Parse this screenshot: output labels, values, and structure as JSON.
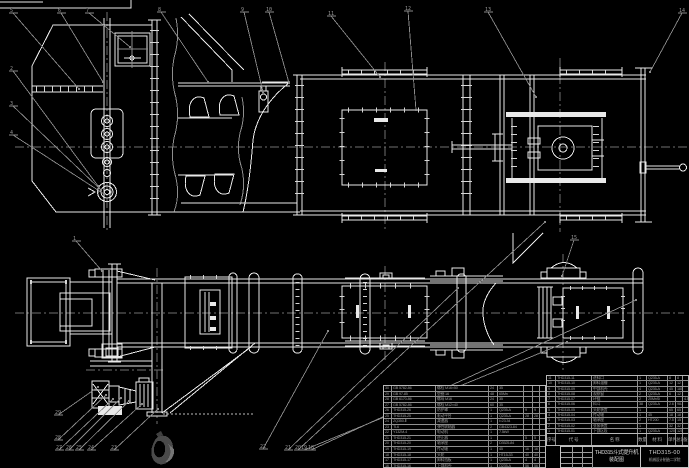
{
  "meta": {
    "background_color": "#000000",
    "line_color": "#e9e9e9",
    "annotation_color": "#8d8d8d",
    "table_text_color": "#9b9b9b",
    "drawing_type": "bucket-elevator assembly CAD drawing"
  },
  "title_block": {
    "product": "THD315斗式提升机",
    "doc_type": "装配图",
    "drawing_no": "THD315-00",
    "org": "机械设计制造二学院",
    "sig_rows": [
      [
        "",
        "",
        ""
      ],
      [
        "",
        "",
        ""
      ],
      [
        "",
        "",
        ""
      ],
      [
        "",
        "",
        ""
      ]
    ]
  },
  "bom_right": {
    "header": [
      "序号",
      "代  号",
      "名  称",
      "数量",
      "材  料",
      "单件",
      "总计",
      "备注"
    ],
    "rows": [
      [
        "11",
        "THD315-11",
        "进料口",
        "1",
        "Q235-A",
        "8",
        "8",
        ""
      ],
      [
        "10",
        "THD315-10",
        "卸料溜槽",
        "1",
        "Q235-A",
        "12",
        "12",
        ""
      ],
      [
        "9",
        "THD315-09",
        "中部机壳",
        "4",
        "Q235-A",
        "45",
        "180",
        ""
      ],
      [
        "8",
        "THD315-08",
        "观察窗",
        "2",
        "Q235-A",
        "6",
        "12",
        ""
      ],
      [
        "7",
        "THD315-07",
        "环链",
        "2",
        "20MnSi",
        "",
        "",
        "4.5m"
      ],
      [
        "6",
        "THD315-06",
        "料斗",
        "38",
        "Q235-A",
        "2.6",
        "98.8",
        ""
      ],
      [
        "5",
        "THD315-05",
        "头轮装置",
        "1",
        "",
        "65",
        "65",
        ""
      ],
      [
        "4",
        "THD315-04",
        "传动轴",
        "1",
        "45",
        "18",
        "18",
        ""
      ],
      [
        "3",
        "THD315-03",
        "轴承座",
        "2",
        "HT200",
        "7.5",
        "15",
        ""
      ],
      [
        "2",
        "THD315-02",
        "张紧装置",
        "1",
        "",
        "32",
        "32",
        ""
      ],
      [
        "1",
        "THD315-01",
        "下部区段",
        "1",
        "Q235-A",
        "120",
        "120",
        ""
      ]
    ]
  },
  "bom_left": {
    "rows": [
      [
        "30",
        "GB 5782-86",
        "螺栓 M16×50",
        "24",
        "35",
        "",
        "",
        ""
      ],
      [
        "29",
        "GB 97-85",
        "垫圈 16",
        "48",
        "65Mn",
        "",
        "",
        ""
      ],
      [
        "28",
        "GB 6170-86",
        "螺母 M16",
        "24",
        "35",
        "",
        "",
        ""
      ],
      [
        "27",
        "GB 5782-86",
        "螺栓 M12×40",
        "60",
        "35",
        "",
        "",
        ""
      ],
      [
        "26",
        "THD315-26",
        "防护罩",
        "1",
        "Q235-A",
        "9",
        "9",
        ""
      ],
      [
        "25",
        "THD315-25",
        "驱动平台",
        "1",
        "Q235-A",
        "28",
        "28",
        ""
      ],
      [
        "24",
        "ZQ350-Ⅱ",
        "减速器",
        "1",
        "i=23.34",
        "",
        "",
        ""
      ],
      [
        "23",
        "TL6",
        "弹性联轴器",
        "2",
        "GB4323-84",
        "",
        "",
        ""
      ],
      [
        "22",
        "Y132M-4",
        "电动机",
        "1",
        "7.5kW",
        "",
        "",
        ""
      ],
      [
        "21",
        "THD315-21",
        "逆止器",
        "1",
        "",
        "5",
        "5",
        ""
      ],
      [
        "20",
        "THD315-20",
        "轴承座",
        "2",
        "D3525-84",
        "",
        "",
        ""
      ],
      [
        "19",
        "THD315-19",
        "传动轴",
        "1",
        "45",
        "16",
        "16",
        ""
      ],
      [
        "18",
        "THD315-18",
        "头轮",
        "1",
        "HT15-33",
        "40",
        "40",
        ""
      ],
      [
        "17",
        "THD315-17",
        "卸料挡板",
        "1",
        "Q235-A",
        "4",
        "4",
        ""
      ],
      [
        "16",
        "THD315-16",
        "上部机壳",
        "1",
        "Q235-A",
        "56",
        "56",
        ""
      ]
    ]
  },
  "callouts": [
    {
      "n": "5",
      "x": 12,
      "y": 11,
      "tx": 79,
      "ty": 89
    },
    {
      "n": "6",
      "x": 60,
      "y": 11,
      "tx": 103,
      "ty": 82
    },
    {
      "n": "7",
      "x": 88,
      "y": 11,
      "tx": 130,
      "ty": 47
    },
    {
      "n": "8",
      "x": 160,
      "y": 10,
      "tx": 208,
      "ty": 82
    },
    {
      "n": "9",
      "x": 243,
      "y": 10,
      "tx": 263,
      "ty": 92
    },
    {
      "n": "10",
      "x": 268,
      "y": 10,
      "tx": 289,
      "ty": 83
    },
    {
      "n": "11",
      "x": 330,
      "y": 14,
      "tx": 380,
      "ty": 77
    },
    {
      "n": "12",
      "x": 407,
      "y": 9,
      "tx": 416,
      "ty": 110
    },
    {
      "n": "13",
      "x": 487,
      "y": 10,
      "tx": 536,
      "ty": 97
    },
    {
      "n": "14",
      "x": 681,
      "y": 11,
      "tx": 650,
      "ty": 72
    },
    {
      "n": "2",
      "x": 12,
      "y": 69,
      "tx": 98,
      "ty": 186
    },
    {
      "n": "3",
      "x": 12,
      "y": 104,
      "tx": 101,
      "ty": 190
    },
    {
      "n": "4",
      "x": 12,
      "y": 133,
      "tx": 104,
      "ty": 194
    },
    {
      "n": "1",
      "x": 75,
      "y": 239,
      "tx": 102,
      "ty": 271
    },
    {
      "n": "15",
      "x": 573,
      "y": 238,
      "tx": 562,
      "ty": 276
    },
    {
      "n": "29",
      "x": 57,
      "y": 413,
      "tx": 98,
      "ty": 387
    },
    {
      "n": "28",
      "x": 57,
      "y": 438,
      "tx": 106,
      "ty": 395
    },
    {
      "n": "27",
      "x": 58,
      "y": 448,
      "tx": 113,
      "ty": 399
    },
    {
      "n": "26",
      "x": 68,
      "y": 448,
      "tx": 121,
      "ty": 398
    },
    {
      "n": "25",
      "x": 78,
      "y": 448,
      "tx": 129,
      "ty": 401
    },
    {
      "n": "24",
      "x": 90,
      "y": 448,
      "tx": 142,
      "ty": 404
    },
    {
      "n": "23",
      "x": 113,
      "y": 448,
      "tx": 158,
      "ty": 409
    },
    {
      "n": "22",
      "x": 262,
      "y": 447,
      "tx": 328,
      "ty": 331
    },
    {
      "n": "21",
      "x": 287,
      "y": 448,
      "tx": 458,
      "ty": 288
    },
    {
      "n": "20",
      "x": 297,
      "y": 448,
      "tx": 545,
      "ty": 222
    },
    {
      "n": "19",
      "x": 303,
      "y": 448,
      "tx": 567,
      "ty": 342
    },
    {
      "n": "18",
      "x": 310,
      "y": 448,
      "tx": 636,
      "ty": 300
    }
  ]
}
